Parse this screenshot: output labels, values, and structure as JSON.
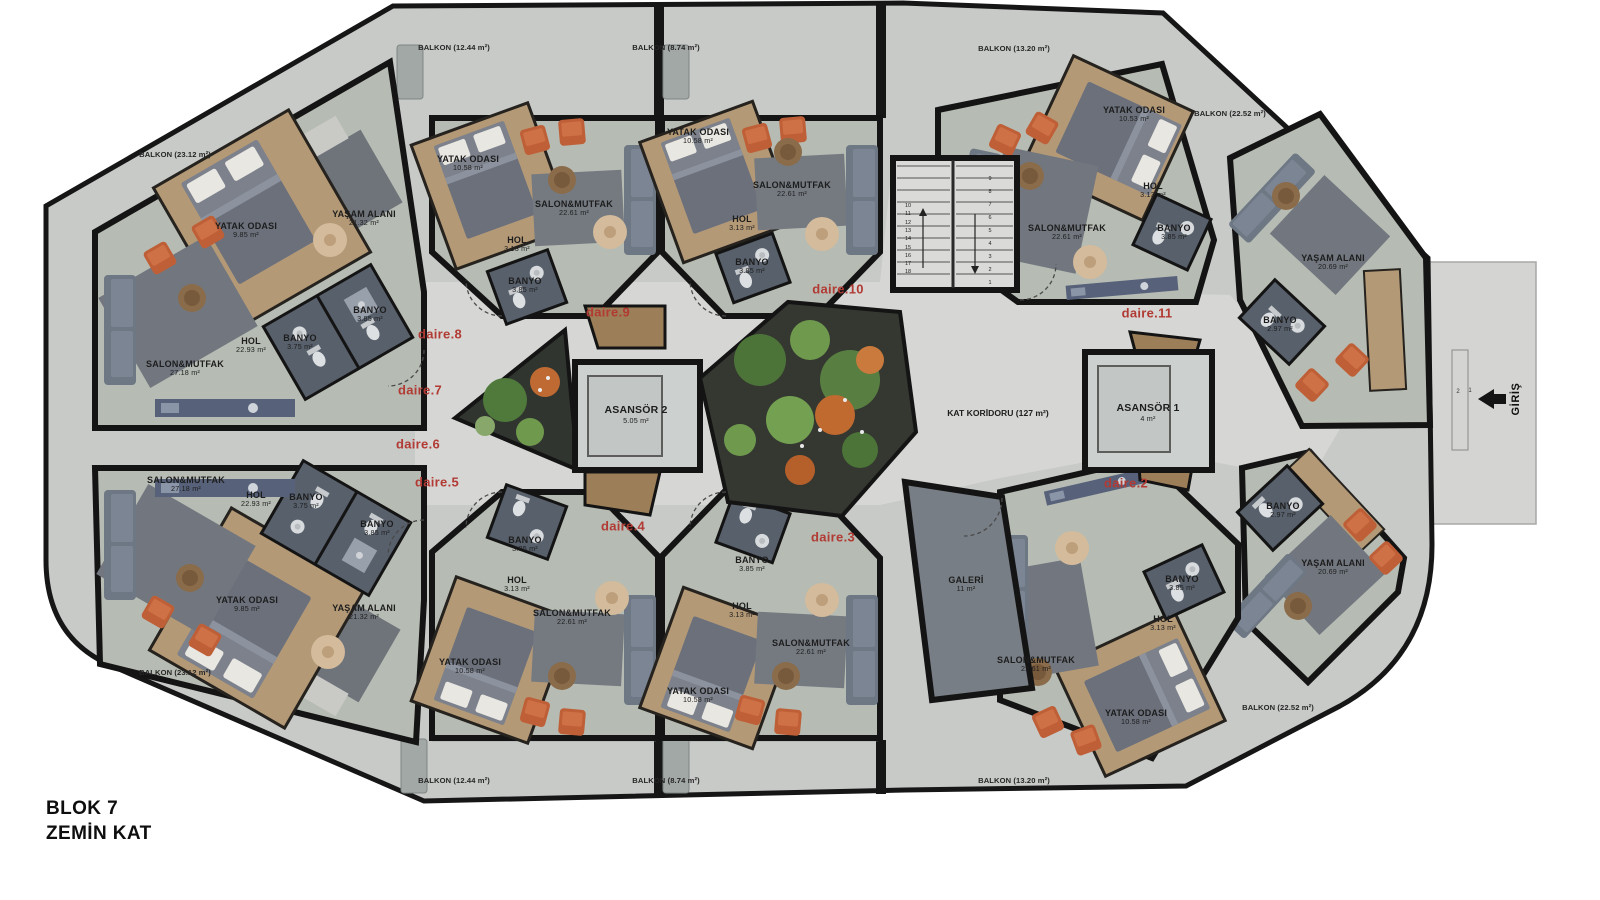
{
  "title": {
    "line1": "BLOK 7",
    "line2": "ZEMİN KAT"
  },
  "palette": {
    "wall": "#141414",
    "floor_living": "#b6bcb3",
    "floor_wood": "#b49976",
    "floor_bath": "#58606b",
    "balcony": "#c8cac8",
    "corridor": "#d6d7d4",
    "accent_red": "#b23a34",
    "armchair": "#bf5f37",
    "sofa": "#6e7784",
    "plant_green": "#4c7438",
    "flower_orange": "#c06a30"
  },
  "plan": {
    "balconies": [
      {
        "t": "BALKON (23.12 m²)",
        "x": 175,
        "y": 155
      },
      {
        "t": "BALKON (12.44 m²)",
        "x": 454,
        "y": 48
      },
      {
        "t": "BALKON (8.74 m²)",
        "x": 666,
        "y": 48
      },
      {
        "t": "BALKON (13.20 m²)",
        "x": 1014,
        "y": 49
      },
      {
        "t": "BALKON (22.52 m²)",
        "x": 1230,
        "y": 114
      },
      {
        "t": "BALKON (23.12 m²)",
        "x": 175,
        "y": 673
      },
      {
        "t": "BALKON (12.44 m²)",
        "x": 454,
        "y": 781
      },
      {
        "t": "BALKON (8.74 m²)",
        "x": 666,
        "y": 781
      },
      {
        "t": "BALKON (13.20 m²)",
        "x": 1014,
        "y": 781
      },
      {
        "t": "BALKON (22.52 m²)",
        "x": 1278,
        "y": 708
      }
    ],
    "rooms": [
      {
        "t": "YATAK ODASI",
        "a": "9.85 m²",
        "x": 246,
        "y": 230
      },
      {
        "t": "YAŞAM ALANI",
        "a": "21.32 m²",
        "x": 364,
        "y": 218
      },
      {
        "t": "SALON&MUTFAK",
        "a": "27.18 m²",
        "x": 185,
        "y": 368
      },
      {
        "t": "HOL",
        "a": "22.93 m²",
        "x": 251,
        "y": 345
      },
      {
        "t": "BANYO",
        "a": "3.75 m²",
        "x": 300,
        "y": 342
      },
      {
        "t": "BANYO",
        "a": "3.85 m²",
        "x": 370,
        "y": 314
      },
      {
        "t": "YATAK ODASI",
        "a": "10.58 m²",
        "x": 468,
        "y": 163
      },
      {
        "t": "SALON&MUTFAK",
        "a": "22.61 m²",
        "x": 574,
        "y": 208
      },
      {
        "t": "HOL",
        "a": "3.13 m²",
        "x": 517,
        "y": 244
      },
      {
        "t": "BANYO",
        "a": "3.85 m²",
        "x": 525,
        "y": 285
      },
      {
        "t": "YATAK ODASI",
        "a": "10.58 m²",
        "x": 698,
        "y": 136
      },
      {
        "t": "SALON&MUTFAK",
        "a": "22.61 m²",
        "x": 792,
        "y": 189
      },
      {
        "t": "HOL",
        "a": "3.13 m²",
        "x": 742,
        "y": 223
      },
      {
        "t": "BANYO",
        "a": "3.85 m²",
        "x": 752,
        "y": 266
      },
      {
        "t": "YATAK ODASI",
        "a": "10.53 m²",
        "x": 1134,
        "y": 114
      },
      {
        "t": "SALON&MUTFAK",
        "a": "22.61 m²",
        "x": 1067,
        "y": 232
      },
      {
        "t": "HOL",
        "a": "3.13 m²",
        "x": 1153,
        "y": 190
      },
      {
        "t": "BANYO",
        "a": "3.85 m²",
        "x": 1174,
        "y": 232
      },
      {
        "t": "YAŞAM ALANI",
        "a": "20.69 m²",
        "x": 1333,
        "y": 262
      },
      {
        "t": "BANYO",
        "a": "2.97 m²",
        "x": 1280,
        "y": 324
      },
      {
        "t": "SALON&MUTFAK",
        "a": "27.18 m²",
        "x": 186,
        "y": 484
      },
      {
        "t": "HOL",
        "a": "22.93 m²",
        "x": 256,
        "y": 499
      },
      {
        "t": "BANYO",
        "a": "3.75 m²",
        "x": 306,
        "y": 501
      },
      {
        "t": "BANYO",
        "a": "3.85 m²",
        "x": 377,
        "y": 528
      },
      {
        "t": "YATAK ODASI",
        "a": "9.85 m²",
        "x": 247,
        "y": 604
      },
      {
        "t": "YAŞAM ALANI",
        "a": "21.32 m²",
        "x": 364,
        "y": 612
      },
      {
        "t": "BANYO",
        "a": "3.85 m²",
        "x": 525,
        "y": 544
      },
      {
        "t": "HOL",
        "a": "3.13 m²",
        "x": 517,
        "y": 584
      },
      {
        "t": "SALON&MUTFAK",
        "a": "22.61 m²",
        "x": 572,
        "y": 617
      },
      {
        "t": "YATAK ODASI",
        "a": "10.58 m²",
        "x": 470,
        "y": 666
      },
      {
        "t": "BANYO",
        "a": "3.85 m²",
        "x": 752,
        "y": 564
      },
      {
        "t": "HOL",
        "a": "3.13 m²",
        "x": 742,
        "y": 610
      },
      {
        "t": "SALON&MUTFAK",
        "a": "22.61 m²",
        "x": 811,
        "y": 647
      },
      {
        "t": "YATAK ODASI",
        "a": "10.58 m²",
        "x": 698,
        "y": 695
      },
      {
        "t": "BANYO",
        "a": "3.85 m²",
        "x": 1182,
        "y": 583
      },
      {
        "t": "HOL",
        "a": "3.13 m²",
        "x": 1163,
        "y": 623
      },
      {
        "t": "SALON&MUTFAK",
        "a": "22.61 m²",
        "x": 1036,
        "y": 664
      },
      {
        "t": "YATAK ODASI",
        "a": "10.58 m²",
        "x": 1136,
        "y": 717
      },
      {
        "t": "BANYO",
        "a": "2.97 m²",
        "x": 1283,
        "y": 510
      },
      {
        "t": "YAŞAM ALANI",
        "a": "20.69 m²",
        "x": 1333,
        "y": 567
      }
    ],
    "apartments": [
      {
        "t": "daire.2",
        "x": 1126,
        "y": 484
      },
      {
        "t": "daire.3",
        "x": 833,
        "y": 538
      },
      {
        "t": "daire.4",
        "x": 623,
        "y": 527
      },
      {
        "t": "daire.5",
        "x": 437,
        "y": 483
      },
      {
        "t": "daire.6",
        "x": 418,
        "y": 445
      },
      {
        "t": "daire.7",
        "x": 420,
        "y": 391
      },
      {
        "t": "daire.8",
        "x": 440,
        "y": 335
      },
      {
        "t": "daire.9",
        "x": 608,
        "y": 313
      },
      {
        "t": "daire.10",
        "x": 838,
        "y": 290
      },
      {
        "t": "daire.11",
        "x": 1147,
        "y": 314
      }
    ],
    "corridor": {
      "t": "KAT KORİDORU (127 m²)",
      "x": 998,
      "y": 414
    },
    "gallery": {
      "t": "GALERİ",
      "a": "11 m²",
      "x": 966,
      "y": 584
    },
    "elevators": [
      {
        "t": "ASANSÖR 2",
        "a": "5.05 m²",
        "x": 636,
        "y": 415
      },
      {
        "t": "ASANSÖR 1",
        "a": "4 m²",
        "x": 1148,
        "y": 413
      }
    ],
    "entrance": {
      "label": "GİRİŞ",
      "x": 1516,
      "y": 399,
      "steps": [
        "2",
        "1"
      ]
    },
    "stairs": {
      "numbers": [
        "1",
        "2",
        "3",
        "4",
        "5",
        "6",
        "7",
        "8",
        "9",
        "10",
        "11",
        "12",
        "13",
        "14",
        "15",
        "16",
        "17",
        "18"
      ]
    }
  }
}
